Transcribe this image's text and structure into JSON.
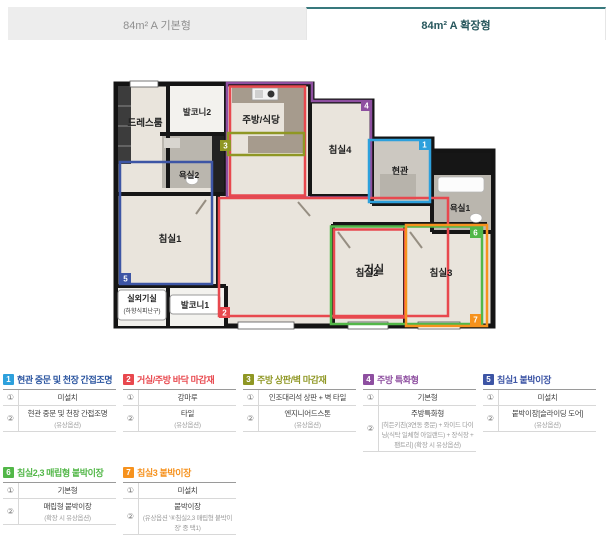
{
  "tabs": [
    {
      "label": "84m² A 기본형",
      "active": false
    },
    {
      "label": "84m² A 확장형",
      "active": true
    }
  ],
  "plan": {
    "rooms": [
      {
        "label": "드레스룸"
      },
      {
        "label": "발코니2"
      },
      {
        "label": "주방/식당"
      },
      {
        "label": "침실4"
      },
      {
        "label": "현관"
      },
      {
        "label": "욕실1"
      },
      {
        "label": "욕실2"
      },
      {
        "label": "침실1"
      },
      {
        "label": "거실"
      },
      {
        "label": "침실2"
      },
      {
        "label": "침실3"
      },
      {
        "label": "실외기실",
        "sublabel": "(하향식피난구)"
      },
      {
        "label": "발코니1"
      }
    ],
    "badges": [
      {
        "num": "1"
      },
      {
        "num": "2"
      },
      {
        "num": "3"
      },
      {
        "num": "4"
      },
      {
        "num": "5"
      },
      {
        "num": "6"
      },
      {
        "num": "7"
      }
    ]
  },
  "legend": {
    "items": [
      {
        "num": "1",
        "color": "#2da0dc",
        "title_color": "#2b55a0",
        "title": "현관 중문 및 천장 간접조명",
        "rows": [
          {
            "num": "①",
            "text": "미설치",
            "note": ""
          },
          {
            "num": "②",
            "text": "현관 중문 및 천장 간접조명",
            "note": "(유상옵션)"
          }
        ]
      },
      {
        "num": "2",
        "color": "#e8484e",
        "title_color": "#e8484e",
        "title": "거실/주방 바닥 마감재",
        "rows": [
          {
            "num": "①",
            "text": "강마루",
            "note": ""
          },
          {
            "num": "②",
            "text": "타일",
            "note": "(유상옵션)"
          }
        ]
      },
      {
        "num": "3",
        "color": "#8f9724",
        "title_color": "#8f9724",
        "title": "주방 상판/벽 마감재",
        "rows": [
          {
            "num": "①",
            "text": "인조대리석 상판 + 벽 타일",
            "note": ""
          },
          {
            "num": "②",
            "text": "엔지니어드스톤",
            "note": "(유상옵션)"
          }
        ]
      },
      {
        "num": "4",
        "color": "#8e4fa0",
        "title_color": "#8e4fa0",
        "title": "주방 특화형",
        "rows": [
          {
            "num": "①",
            "text": "기본형",
            "note": ""
          },
          {
            "num": "②",
            "text": "주방특화형",
            "note": "[히든키친(3연동 중문) + 와이드 다이닝(식탁 일체형 아일랜드) + 장식장 + 팬트리] (확장 시 유상옵션)"
          }
        ]
      },
      {
        "num": "5",
        "color": "#3d55a5",
        "title_color": "#3d55a5",
        "title": "침실1 붙박이장",
        "rows": [
          {
            "num": "①",
            "text": "미설치",
            "note": ""
          },
          {
            "num": "②",
            "text": "붙박이장[슬라이딩 도어]",
            "note": "(유상옵션)"
          }
        ]
      },
      {
        "num": "6",
        "color": "#52b748",
        "title_color": "#52b748",
        "title": "침실2,3 매립형 붙박이장",
        "rows": [
          {
            "num": "①",
            "text": "기본형",
            "note": ""
          },
          {
            "num": "②",
            "text": "매립형 붙박이장",
            "note": "(확장 시 유상옵션)"
          }
        ]
      },
      {
        "num": "7",
        "color": "#f6921e",
        "title_color": "#f6921e",
        "title": "침실3 붙박이장",
        "rows": [
          {
            "num": "①",
            "text": "미설치",
            "note": ""
          },
          {
            "num": "②",
            "text": "붙박이장",
            "note": "(유상옵션 '⑥침실2,3 매립형 붙박이장' 중 택1)"
          }
        ]
      }
    ]
  }
}
